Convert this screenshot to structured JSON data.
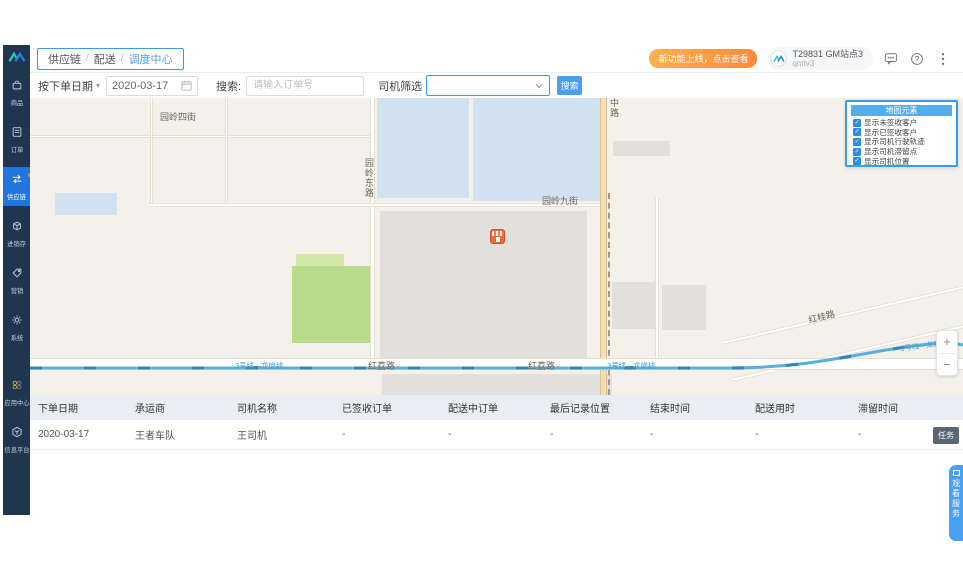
{
  "sidebar": {
    "items": [
      {
        "label": "商品",
        "icon": "bag-icon"
      },
      {
        "label": "订单",
        "icon": "order-icon"
      },
      {
        "label": "供应链",
        "icon": "supply-chain-icon",
        "active": true
      },
      {
        "label": "进销存",
        "icon": "inventory-icon"
      },
      {
        "label": "营销",
        "icon": "marketing-icon"
      },
      {
        "label": "系统",
        "icon": "gear-icon"
      }
    ],
    "bottom_items": [
      {
        "label": "应用中心",
        "icon": "app-center-icon"
      },
      {
        "label": "信息平台",
        "icon": "info-platform-icon"
      }
    ]
  },
  "header": {
    "breadcrumb": {
      "root": "供应链",
      "section": "配送",
      "current": "调度中心"
    },
    "promo": "新功能上线，点击查看",
    "account": {
      "name": "T29831 GM站点3",
      "subname": "qmtv3"
    }
  },
  "filters": {
    "date_type_label": "按下单日期",
    "date_value": "2020-03-17",
    "search_label": "搜索:",
    "order_placeholder": "请输入订单号",
    "driver_label": "司机筛选",
    "driver_value": "",
    "search_button": "搜索"
  },
  "map": {
    "streets": {
      "yuanling4": "园岭四街",
      "yuanlingdong": "园岭东路",
      "yuanling9": "园岭九街",
      "zhonglu": "中路",
      "hongli_1": "红荔路",
      "hongli_2": "红荔路",
      "honggui": "红桂路",
      "metro_1": "3号线—龙岗线",
      "metro_2": "3号线—龙岗线",
      "metro_3": "3号线—龙岗线"
    },
    "panel": {
      "title": "地图元素",
      "options": [
        {
          "label": "显示未签收客户",
          "checked": true
        },
        {
          "label": "显示已签收客户",
          "checked": true
        },
        {
          "label": "显示司机行驶轨迹",
          "checked": true
        },
        {
          "label": "显示司机滞留点",
          "checked": true
        },
        {
          "label": "显示司机位置",
          "checked": true
        }
      ]
    },
    "zoom_in": "+",
    "zoom_out": "−"
  },
  "table": {
    "columns": [
      "下单日期",
      "承运商",
      "司机名称",
      "已签收订单",
      "配送中订单",
      "最后记录位置",
      "结束时间",
      "配送用时",
      "滞留时间"
    ],
    "row": {
      "cells": [
        "2020-03-17",
        "王者车队",
        "王司机",
        "-",
        "-",
        "-",
        "-",
        "-",
        "-"
      ],
      "action": "任务"
    }
  },
  "ribbon": {
    "label": "观看服务"
  },
  "colors": {
    "accent": "#3d9ae8",
    "sidebar": "#20364e",
    "promo_orange": "#ff8a3d",
    "active_blue": "#2176dd"
  }
}
